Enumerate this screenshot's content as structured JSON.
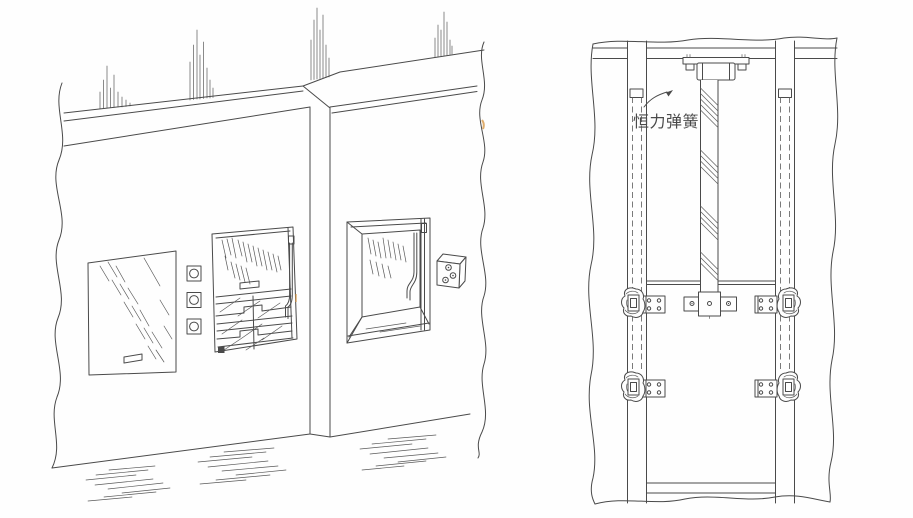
{
  "figure": {
    "kind": "technical-line-illustration",
    "colors": {
      "background": "#fefefe",
      "ink": "#4a4a4a",
      "scan_artifact": "#d89a4a"
    },
    "left_view": {
      "label": ""
    },
    "right_view": {
      "annotation": {
        "label": "恒力弹簧"
      }
    }
  }
}
